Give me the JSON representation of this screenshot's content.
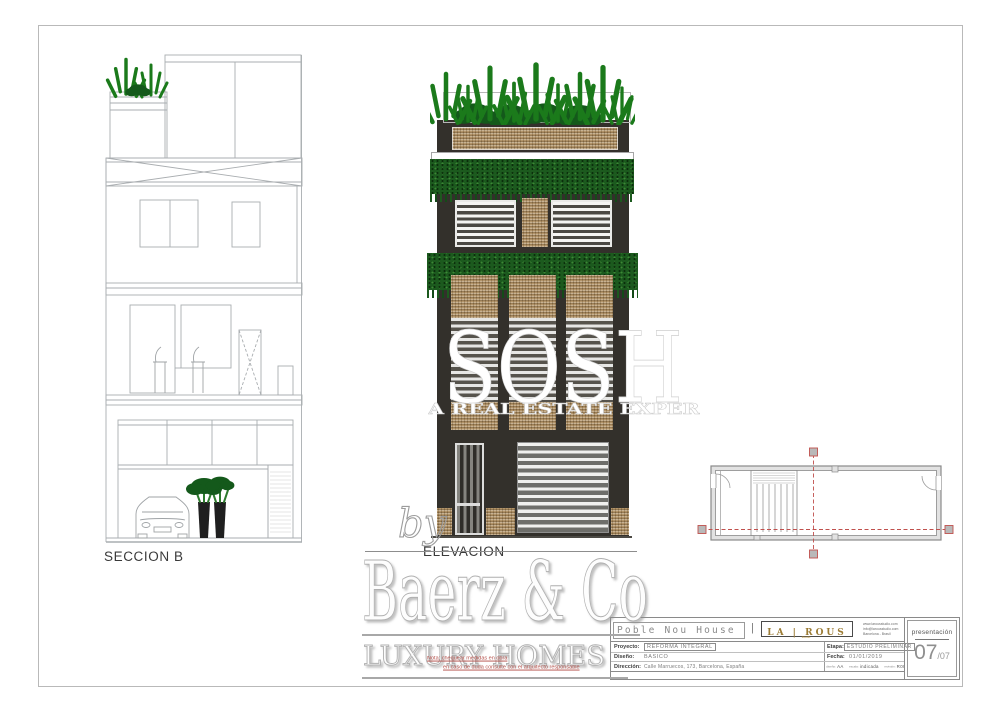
{
  "sheet": {
    "presentation_label": "presentación",
    "page_number": "07",
    "page_total": "/07"
  },
  "labels": {
    "section": "SECCION B",
    "elevation": "ELEVACION"
  },
  "watermarks": {
    "by": "by",
    "brand": "Baerz & Co",
    "brand_sub": "LUXURY HOMES",
    "overlay_word": "SOSH",
    "overlay_tagline": "A REAL ESTATE EXPERIENCE",
    "note_line1": "Nota: chequear medidas en obra",
    "note_line2": "en caso de duda consulte con el arquitecto responsable"
  },
  "title_block": {
    "project_name": "Poble Nou House",
    "separator": "|",
    "logo": "LA | ROUS",
    "logo_sub": "studio",
    "contact_lines": [
      "www.larousstudio.com",
      "info@larousstudio.com",
      "Barcelona - Brasil"
    ],
    "fields_left": [
      {
        "label": "Proyecto:",
        "value": "REFORMA INTEGRAL"
      },
      {
        "label": "Diseño:",
        "value": "BASICO"
      },
      {
        "label": "Dirección:",
        "value": "Calle Marruecos, 173, Barcelona, España"
      }
    ],
    "fields_right": [
      {
        "label": "Etapa:",
        "value": "ESTUDIO PRELIMINAR"
      },
      {
        "label": "Fecha:",
        "value": "01/01/2019"
      }
    ],
    "meta": [
      {
        "label": "diseño:",
        "value": "AA"
      },
      {
        "label": "escala:",
        "value": "indicada"
      },
      {
        "label": "revisión:",
        "value": "R00"
      }
    ]
  },
  "colors": {
    "facade": "#33302b",
    "brick": "#b3956a",
    "vegetation": "#1c5a1e",
    "section_line": "#a9adb0",
    "red_marker": "#c0504d",
    "gold": "#9c7c35"
  }
}
